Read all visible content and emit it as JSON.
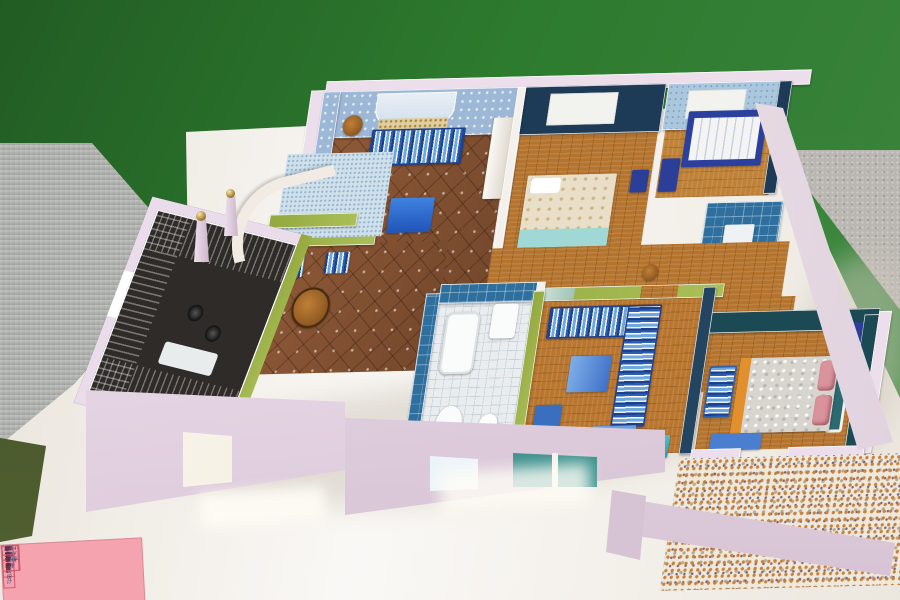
{
  "scene": {
    "description": "Photograph of a handmade interior-design scale model of a Mediterranean-style apartment, displayed on a white table in front of a green wall",
    "wall_color": "#2d7b2f",
    "side_table_color": "#b2b4b0",
    "carpet_floor_color": "#bab7b2",
    "floor_accent_color": "#49552e",
    "display_table_color": "#f5f2ec"
  },
  "model": {
    "style_note": "Mediterranean home interior scale model, pink exterior walls with white edges",
    "exterior_wall_color": "#ecdfeb",
    "counter_color": "#56c6d6",
    "rooms": [
      {
        "name": "living-room",
        "floor": "#8a5a3c",
        "wall": "#9db8d6",
        "furniture": [
          "striped sofa",
          "two striped armchairs",
          "blue coffee table",
          "round wooden stools",
          "arched alcove"
        ]
      },
      {
        "name": "bedroom",
        "floor": "#b5742e",
        "wall": "#1d3a57",
        "furniture": [
          "double bed with beige spread and cyan throw",
          "white wall panel",
          "navy nightstand"
        ]
      },
      {
        "name": "kids-room",
        "floor": "#c08238",
        "wall": "#abc7dd",
        "furniture": [
          "navy crib",
          "navy dresser",
          "white wall panel"
        ]
      },
      {
        "name": "small-bathroom",
        "floor": "#2e6f9e",
        "wall": "#2e6f9e",
        "furniture": [
          "washstand"
        ]
      },
      {
        "name": "dining-area",
        "floor": "#8a5a3c",
        "wall": "#93a83e",
        "furniture": [
          "round wooden table",
          "striped chairs"
        ]
      },
      {
        "name": "kitchen",
        "floor": "#2f2b28",
        "wall": "#a8b45a",
        "furniture": [
          "turquoise U-shaped counter",
          "stove",
          "sink"
        ]
      },
      {
        "name": "main-bathroom",
        "floor": "#e9edf0",
        "wall": "#2e6f9e",
        "furniture": [
          "bathtub",
          "washbasin",
          "toilet",
          "teal counter with water heater"
        ]
      },
      {
        "name": "study-lounge",
        "floor": "#b9762f",
        "wall": "#a8b45a",
        "furniture": [
          "striped corner sofa",
          "blue table",
          "blue chair",
          "blue desk",
          "teal cabinet",
          "mirror openings"
        ]
      },
      {
        "name": "master-bedroom",
        "floor": "#b5742e",
        "wall": "#1c4a54",
        "furniture": [
          "double bed with silver damask spread",
          "pink pillows",
          "orange footboard",
          "white framed headboard",
          "blue striped bench"
        ]
      },
      {
        "name": "balcony",
        "floor": "#efe9dc",
        "wall": "#ecdfeb",
        "furniture": [
          "pebble mosaic floor"
        ]
      },
      {
        "name": "entrance",
        "floor": "#cfe0ea",
        "wall": "#f3ece6",
        "furniture": [
          "curved parapet",
          "two pillars with gold ball finials"
        ]
      }
    ]
  },
  "label_card": {
    "bg_color": "#f6a3b0",
    "rows": [
      {
        "label": "展览名称",
        "value": "毕业作品展"
      },
      {
        "label": "作　品",
        "value": "地中海家装设计"
      },
      {
        "label": "作　者",
        "value": "陈业、黄丽丽"
      },
      {
        "label": "年级专业",
        "value": "2014级环境设计"
      },
      {
        "label": "指导教师",
        "value": "丁"
      }
    ]
  }
}
